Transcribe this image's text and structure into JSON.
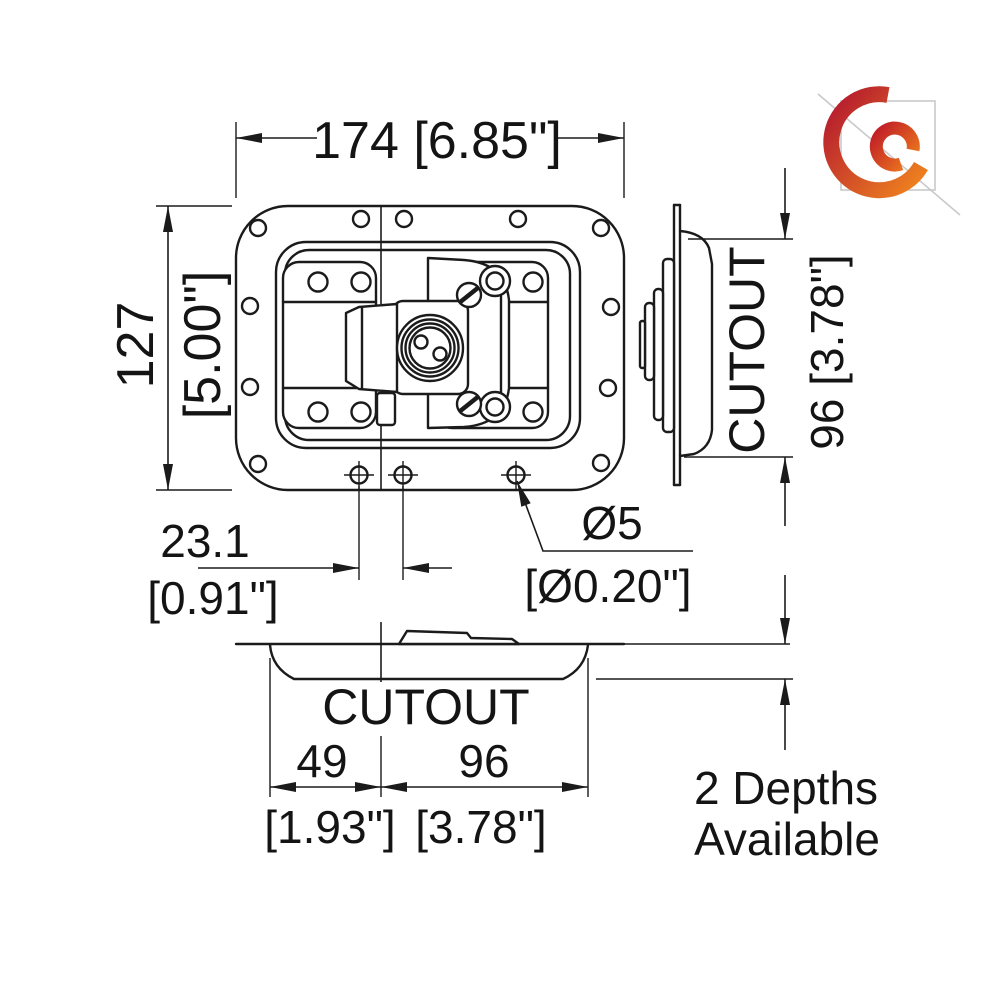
{
  "drawing": {
    "type": "technical-drawing",
    "subject": "recessed butterfly latch in dish - dimensioned 3-view drawing",
    "line_color": "#1b1b1b",
    "background": "#ffffff"
  },
  "dimensions": {
    "overall_width": "174 [6.85\"]",
    "overall_height_mm": "127",
    "overall_height_in": "[5.00\"]",
    "hole_offset_mm": "23.1",
    "hole_offset_in": "[0.91\"]",
    "hole_diameter_mm": "Ø5",
    "hole_diameter_in": "[Ø0.20\"]",
    "side_cutout_label": "CUTOUT",
    "side_cutout_height": "96 [3.78\"]",
    "bottom_cutout_label": "CUTOUT",
    "cutout_left_mm": "49",
    "cutout_left_in": "[1.93\"]",
    "cutout_right_mm": "96",
    "cutout_right_in": "[3.78\"]"
  },
  "notes": {
    "depths_line1": "2 Depths",
    "depths_line2": "Available"
  },
  "logo": {
    "name": "orange-swirl-logo",
    "red": "#bb1f2c",
    "orange": "#f2851e",
    "watermark_gray": "#c9c9c9"
  }
}
